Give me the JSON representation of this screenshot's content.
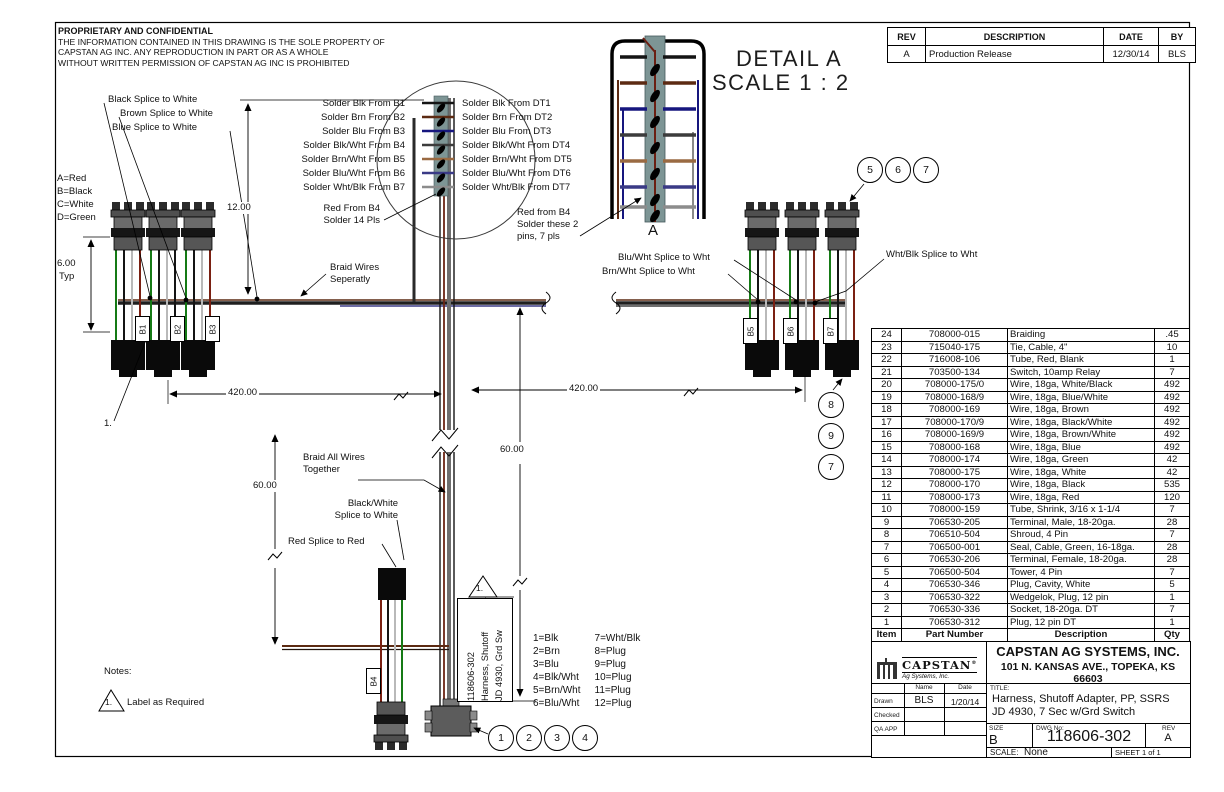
{
  "notice": {
    "title": "PROPRIETARY AND CONFIDENTIAL",
    "lines": [
      "THE INFORMATION CONTAINED IN THIS DRAWING IS THE SOLE PROPERTY OF",
      "CAPSTAN AG INC. ANY REPRODUCTION IN PART OR AS A WHOLE",
      "WITHOUT WRITTEN PERMISSION OF CAPSTAN AG INC IS PROHIBITED"
    ]
  },
  "rev_table": {
    "headers": [
      "REV",
      "DESCRIPTION",
      "DATE",
      "BY"
    ],
    "rows": [
      [
        "A",
        "Production Release",
        "12/30/14",
        "BLS"
      ]
    ]
  },
  "detail": {
    "title": "DETAIL A",
    "scale": "SCALE 1 : 2",
    "view_label": "A"
  },
  "solder": {
    "left": [
      "Solder Blk From B1",
      "Solder Brn From B2",
      "Solder Blu From B3",
      "Solder Blk/Wht From B4",
      "Solder Brn/Wht From B5",
      "Solder Blu/Wht From B6",
      "Solder Wht/Blk From B7"
    ],
    "right": [
      "Solder Blk From DT1",
      "Solder Brn From DT2",
      "Solder Blu From DT3",
      "Solder Blk/Wht From DT4",
      "Solder Brn/Wht From DT5",
      "Solder Blu/Wht From DT6",
      "Solder Wht/Blk From DT7"
    ]
  },
  "labels": {
    "black_splice": "Black Splice to White",
    "brown_splice": "Brown Splice to White",
    "blue_splice": "Blue Splice to White",
    "abcd": [
      "A=Red",
      "B=Black",
      "C=White",
      "D=Green"
    ],
    "braid_sep": [
      "Braid Wires",
      "Seperatly"
    ],
    "blu_wht_splice": "Blu/Wht Splice to Wht",
    "brn_wht_splice": "Brn/Wht Splice to Wht",
    "wht_blk_splice": "Wht/Blk Splice to Wht",
    "braid_all": [
      "Braid All Wires",
      "Together"
    ],
    "bw_splice": [
      "Black/White",
      "Splice to White"
    ],
    "red_splice": "Red Splice to Red",
    "red_from_b4_left": [
      "Red From B4",
      "Solder 14 Pls"
    ],
    "red_from_b4_right": [
      "Red from B4",
      "Solder these 2",
      "pins, 7 pls"
    ],
    "item_note": "1."
  },
  "dims": {
    "d600": "6.00",
    "d600b": "Typ",
    "d1200": "12.00",
    "d420l": "420.00",
    "d420r": "420.00",
    "d60l": "60.00",
    "d60r": "60.00"
  },
  "connectors": [
    "B1",
    "B2",
    "B3",
    "B4",
    "B5",
    "B6",
    "B7"
  ],
  "notes": {
    "title": "Notes:",
    "flag": "1.",
    "text": "Label as Required",
    "flag2": "1."
  },
  "wire_legend": {
    "left": [
      "1=Blk",
      "2=Brn",
      "3=Blu",
      "4=Blk/Wht",
      "5=Brn/Wht",
      "6=Blu/Wht"
    ],
    "right": [
      "7=Wht/Blk",
      "8=Plug",
      "9=Plug",
      "10=Plug",
      "11=Plug",
      "12=Plug"
    ]
  },
  "vertical_tag": [
    "118606-302",
    "Harness, Shutoff",
    "JD 4930, Grd Sw"
  ],
  "balloons": {
    "top_right": [
      "5",
      "6",
      "7"
    ],
    "right_col": [
      "8",
      "9",
      "7"
    ],
    "bottom": [
      "1",
      "2",
      "3",
      "4"
    ]
  },
  "bom": {
    "headers": [
      "Item",
      "Part Number",
      "Description",
      "Qty"
    ],
    "rows": [
      [
        "24",
        "708000-015",
        "Braiding",
        ".45"
      ],
      [
        "23",
        "715040-175",
        "Tie, Cable, 4\"",
        "10"
      ],
      [
        "22",
        "716008-106",
        "Tube, Red, Blank",
        "1"
      ],
      [
        "21",
        "703500-134",
        "Switch, 10amp Relay",
        "7"
      ],
      [
        "20",
        "708000-175/0",
        "Wire, 18ga, White/Black",
        "492"
      ],
      [
        "19",
        "708000-168/9",
        "Wire, 18ga, Blue/White",
        "492"
      ],
      [
        "18",
        "708000-169",
        "Wire, 18ga, Brown",
        "492"
      ],
      [
        "17",
        "708000-170/9",
        "Wire, 18ga, Black/White",
        "492"
      ],
      [
        "16",
        "708000-169/9",
        "Wire, 18ga, Brown/White",
        "492"
      ],
      [
        "15",
        "708000-168",
        "Wire, 18ga, Blue",
        "492"
      ],
      [
        "14",
        "708000-174",
        "Wire, 18ga, Green",
        "42"
      ],
      [
        "13",
        "708000-175",
        "Wire, 18ga, White",
        "42"
      ],
      [
        "12",
        "708000-170",
        "Wire, 18ga, Black",
        "535"
      ],
      [
        "11",
        "708000-173",
        "Wire, 18ga, Red",
        "120"
      ],
      [
        "10",
        "708000-159",
        "Tube, Shrink, 3/16 x 1-1/4",
        "7"
      ],
      [
        "9",
        "706530-205",
        "Terminal, Male, 18-20ga.",
        "28"
      ],
      [
        "8",
        "706510-504",
        "Shroud, 4 Pin",
        "7"
      ],
      [
        "7",
        "706500-001",
        "Seal, Cable, Green, 16-18ga.",
        "28"
      ],
      [
        "6",
        "706530-206",
        "Terminal, Female, 18-20ga.",
        "28"
      ],
      [
        "5",
        "706500-504",
        "Tower, 4 Pin",
        "7"
      ],
      [
        "4",
        "706530-346",
        "Plug, Cavity, White",
        "5"
      ],
      [
        "3",
        "706530-322",
        "Wedgelok, Plug, 12 pin",
        "1"
      ],
      [
        "2",
        "706530-336",
        "Socket, 18-20ga. DT",
        "7"
      ],
      [
        "1",
        "706530-312",
        "Plug, 12 pin DT",
        "1"
      ]
    ]
  },
  "title_block": {
    "logo_line1": "CAPSTAN",
    "logo_reg": "®",
    "logo_line2": "Ag Systems, Inc.",
    "company": "CAPSTAN AG SYSTEMS, INC.",
    "address": "101 N. KANSAS AVE., TOPEKA, KS 66603",
    "col_name": "Name",
    "col_date": "Date",
    "rows": [
      [
        "Drawn",
        "BLS",
        "1/20/14"
      ],
      [
        "Checked",
        "",
        ""
      ],
      [
        "QA APP",
        "",
        ""
      ]
    ],
    "title_label": "TITLE:",
    "title_line1": "Harness, Shutoff Adapter, PP, SSRS",
    "title_line2": "JD 4930, 7 Sec w/Grd Switch",
    "size_label": "SIZE",
    "size": "B",
    "dwg_label": "DWG No:",
    "dwg_no": "118606-302",
    "rev_label": "REV",
    "rev": "A",
    "scale_label": "SCALE:",
    "scale": "None",
    "sheet": "SHEET 1 of 1"
  },
  "colors": {
    "wire_green": "#157a15",
    "wire_black": "#141414",
    "wire_white": "#b9b9b9",
    "wire_red": "#7a2012",
    "wire_brown": "#5c2a12",
    "wire_blue": "#16167e",
    "solder_strip": "#7d9595"
  }
}
